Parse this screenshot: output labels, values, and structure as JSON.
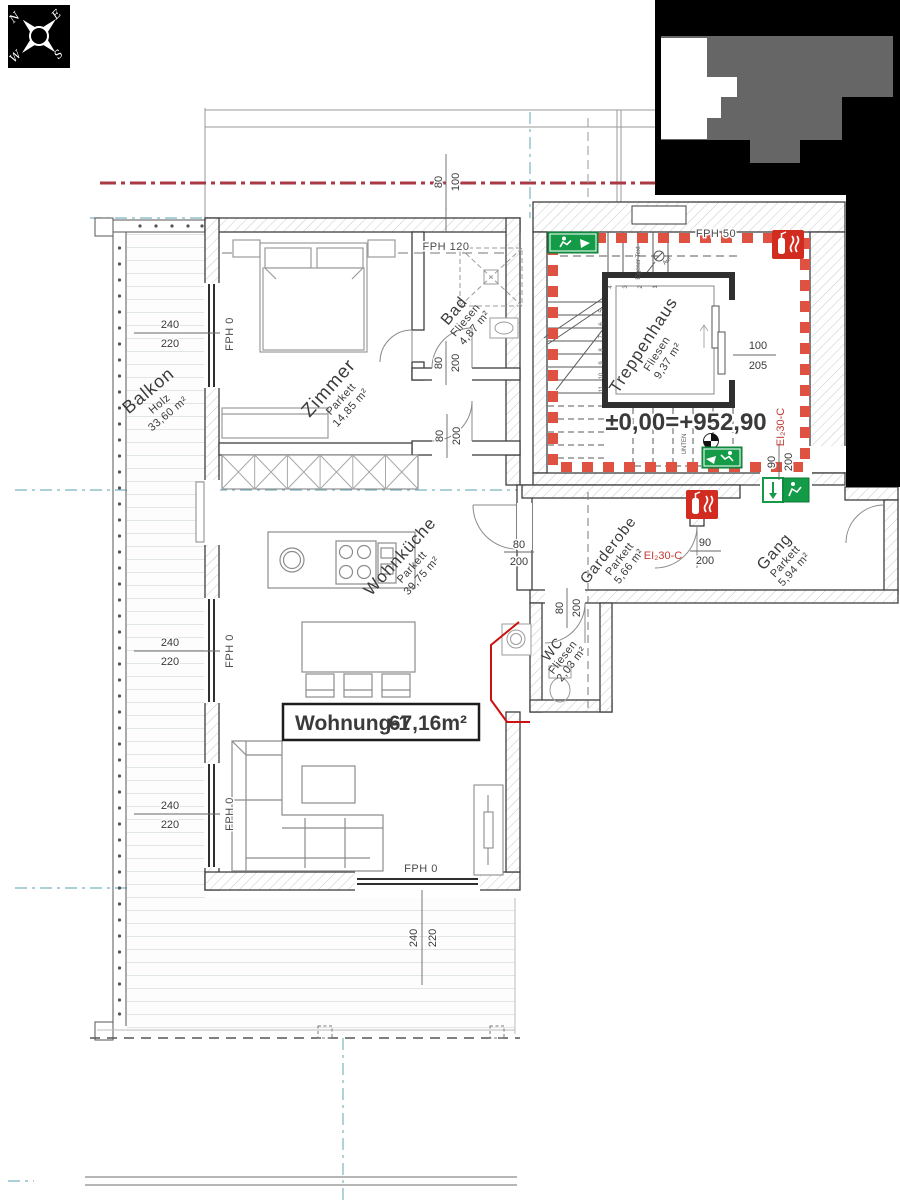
{
  "title_box": {
    "name": "Wohnung-1",
    "area": "67,16m²"
  },
  "elevation_label": "±0,00=+952,90",
  "compass": {
    "n": "N",
    "e": "E",
    "s": "S",
    "w": "W"
  },
  "rooms": [
    {
      "name": "Zimmer",
      "finish": "Parkett",
      "area": "14,85 m²"
    },
    {
      "name": "Bad",
      "finish": "Fliesen",
      "area": "4,87 m²"
    },
    {
      "name": "Wohnküche",
      "finish": "Parkett",
      "area": "39,75 m²"
    },
    {
      "name": "Balkon",
      "finish": "Holz",
      "area": "33,60 m²"
    },
    {
      "name": "Treppenhaus",
      "finish": "Fliesen",
      "area": "9,37 m²"
    },
    {
      "name": "Garderobe",
      "finish": "Parkett",
      "area": "5,66 m²"
    },
    {
      "name": "Gang",
      "finish": "Parkett",
      "area": "5,94 m²"
    },
    {
      "name": "WC",
      "finish": "Fliesen",
      "area": "2,03 m²"
    }
  ],
  "wall_labels": {
    "fph0": "FPH 0",
    "fph50": "FPH 50",
    "fph120": "FPH 120"
  },
  "fire_rating": "EI₂30-C",
  "stair_labels": {
    "eigener_text": "Eigener Text",
    "auf": "Auf",
    "unten": "UNTEN",
    "numbers_upper": [
      "4",
      "3",
      "2",
      "1"
    ],
    "numbers_lower": [
      "5",
      "6",
      "7",
      "8",
      "9",
      "10",
      "11"
    ]
  },
  "dimensions": {
    "w240": "240",
    "h220": "220",
    "d80": "80",
    "d90": "90",
    "d100": "100",
    "h200": "200",
    "lift_w": "100",
    "lift_h": "205"
  },
  "colors": {
    "exit_green": "#149b48",
    "fire_red": "#d22b1f",
    "fire_dash_red": "#df5242",
    "axis_red": "#a93a44",
    "axis_teal": "#8fc0cb",
    "keyplan_gray": "#666666",
    "wall_dark": "#3f3f3f"
  }
}
